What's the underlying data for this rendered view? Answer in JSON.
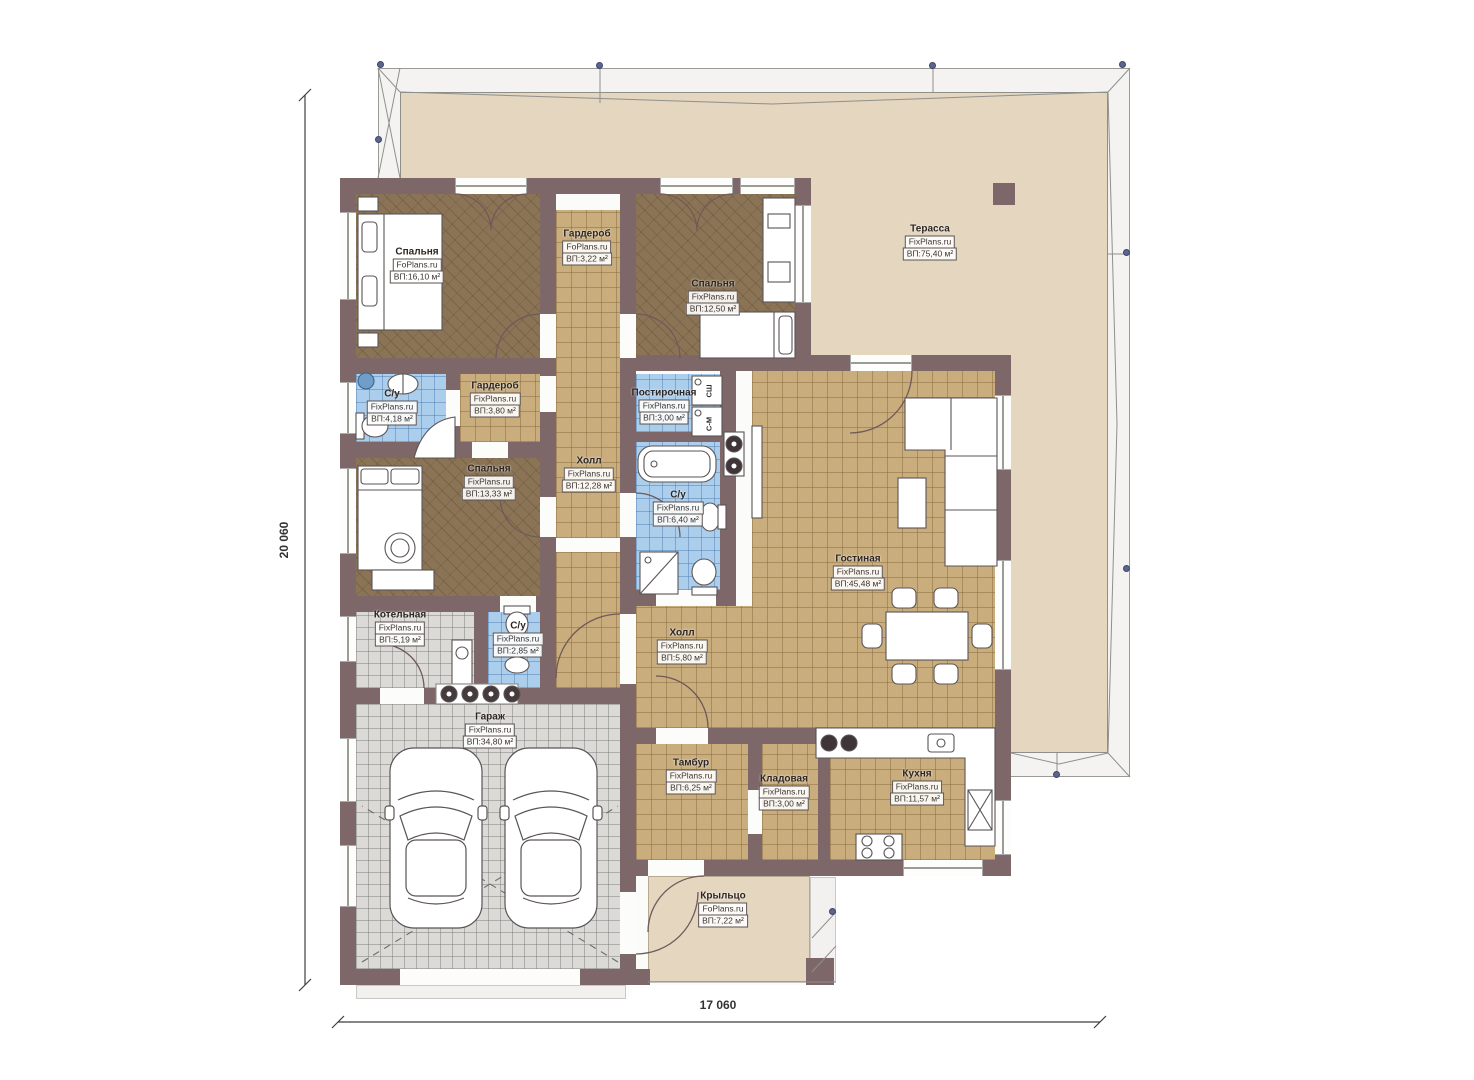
{
  "drawing": {
    "type": "single-storey house floor plan",
    "dimensions": {
      "left": "20 060",
      "bottom": "17 060"
    },
    "area_prefix": "ВП:",
    "colors": {
      "wall": "#7d6769",
      "terrace_floor": "#e4d6bf",
      "wood_floor": "#8b7456",
      "tile_tan": "#c9ad7d",
      "tile_blue": "#abceec",
      "tile_gray": "#dbdad7",
      "survey_dot": "#5b6590"
    },
    "appliances": {
      "dryer": "СШ",
      "washer": "С-М"
    }
  },
  "plan": {
    "rooms": [
      {
        "id": "bedroom-1",
        "name": "Спальня",
        "brand": "FoPlans.ru",
        "area": "ВП:16,10 м²",
        "label": [
          417,
          265
        ],
        "floor": [
          356,
          194,
          184,
          164
        ],
        "floor_type": "wood"
      },
      {
        "id": "wardrobe-top",
        "name": "Гардероб",
        "brand": "FoPlans.ru",
        "area": "ВП:3,22 м²",
        "label": [
          587,
          247
        ],
        "floor": [
          556,
          210,
          64,
          108
        ],
        "floor_type": "tan"
      },
      {
        "id": "bedroom-2",
        "name": "Спальня",
        "brand": "FixPlans.ru",
        "area": "ВП:12,50 м²",
        "label": [
          713,
          297
        ],
        "floor": [
          636,
          194,
          159,
          161
        ],
        "floor_type": "wood"
      },
      {
        "id": "terrace",
        "name": "Терасса",
        "brand": "FixPlans.ru",
        "area": "ВП:75,40 м²",
        "label": [
          930,
          242
        ],
        "floor": null,
        "floor_type": "beige"
      },
      {
        "id": "bath-1",
        "name": "С/у",
        "brand": "FixPlans.ru",
        "area": "ВП:4,18 м²",
        "label": [
          392,
          407
        ],
        "floor": [
          356,
          374,
          90,
          68
        ],
        "floor_type": "blue"
      },
      {
        "id": "wardrobe-2",
        "name": "Гардероб",
        "brand": "FixPlans.ru",
        "area": "ВП:3,80 м²",
        "label": [
          495,
          399
        ],
        "floor": [
          460,
          374,
          80,
          68
        ],
        "floor_type": "tan"
      },
      {
        "id": "bedroom-3",
        "name": "Спальня",
        "brand": "FixPlans.ru",
        "area": "ВП:13,33 м²",
        "label": [
          489,
          482
        ],
        "floor": [
          356,
          458,
          184,
          138
        ],
        "floor_type": "wood"
      },
      {
        "id": "hall-1",
        "name": "Холл",
        "brand": "FixPlans.ru",
        "area": "ВП:12,28 м²",
        "label": [
          589,
          474
        ],
        "floor": [
          556,
          310,
          64,
          378
        ],
        "floor_type": "tan"
      },
      {
        "id": "laundry",
        "name": "Постирочная",
        "brand": "FixPlans.ru",
        "area": "ВП:3,00 м²",
        "label": [
          664,
          406
        ],
        "floor": [
          636,
          374,
          84,
          58
        ],
        "floor_type": "blue"
      },
      {
        "id": "bath-2",
        "name": "С/у",
        "brand": "FixPlans.ru",
        "area": "ВП:6,40 м²",
        "label": [
          678,
          508
        ],
        "floor": [
          636,
          442,
          84,
          148
        ],
        "floor_type": "blue"
      },
      {
        "id": "living-room",
        "name": "Гостиная",
        "brand": "FixPlans.ru",
        "area": "ВП:45,48 м²",
        "label": [
          858,
          572
        ],
        "floor": [
          752,
          371,
          243,
          357
        ],
        "floor_type": "tan"
      },
      {
        "id": "boiler-room",
        "name": "Котельная",
        "brand": "FixPlans.ru",
        "area": "ВП:5,19 м²",
        "label": [
          400,
          628
        ],
        "floor": [
          356,
          612,
          118,
          76
        ],
        "floor_type": "gray"
      },
      {
        "id": "bath-3",
        "name": "С/у",
        "brand": "FixPlans.ru",
        "area": "ВП:2,85 м²",
        "label": [
          518,
          639
        ],
        "floor": [
          488,
          612,
          52,
          76
        ],
        "floor_type": "blue"
      },
      {
        "id": "hall-2",
        "name": "Холл",
        "brand": "FixPlans.ru",
        "area": "ВП:5,80 м²",
        "label": [
          682,
          646
        ],
        "floor": [
          636,
          606,
          116,
          122
        ],
        "floor_type": "tan"
      },
      {
        "id": "garage",
        "name": "Гараж",
        "brand": "FixPlans.ru",
        "area": "ВП:34,80 м²",
        "label": [
          490,
          730
        ],
        "floor": [
          356,
          704,
          264,
          265
        ],
        "floor_type": "gray"
      },
      {
        "id": "vestibule",
        "name": "Тамбур",
        "brand": "FixPlans.ru",
        "area": "ВП:6,25 м²",
        "label": [
          691,
          776
        ],
        "floor": [
          636,
          744,
          112,
          116
        ],
        "floor_type": "tan"
      },
      {
        "id": "storage",
        "name": "Кладовая",
        "brand": "FixPlans.ru",
        "area": "ВП:3,00 м²",
        "label": [
          784,
          792
        ],
        "floor": [
          762,
          744,
          56,
          116
        ],
        "floor_type": "tan"
      },
      {
        "id": "kitchen",
        "name": "Кухня",
        "brand": "FixPlans.ru",
        "area": "ВП:11,57 м²",
        "label": [
          917,
          787
        ],
        "floor": [
          830,
          744,
          165,
          116
        ],
        "floor_type": "tan"
      },
      {
        "id": "porch",
        "name": "Крыльцо",
        "brand": "FoPlans.ru",
        "area": "ВП:7,22 м²",
        "label": [
          723,
          909
        ],
        "floor": [
          648,
          876,
          162,
          106
        ],
        "floor_type": "beige"
      }
    ],
    "roof": {
      "outer": [
        378,
        68,
        752,
        709
      ],
      "inner": [
        400,
        92,
        708,
        661
      ]
    },
    "base": [
      [
        340,
        178,
        471,
        807
      ],
      [
        745,
        355,
        266,
        521
      ]
    ],
    "walls": [
      [
        340,
        178,
        471,
        16
      ],
      [
        340,
        178,
        16,
        807
      ],
      [
        340,
        969,
        310,
        16
      ],
      [
        795,
        178,
        16,
        193
      ],
      [
        811,
        355,
        200,
        16
      ],
      [
        995,
        355,
        16,
        360
      ],
      [
        995,
        715,
        16,
        145
      ],
      [
        810,
        860,
        201,
        16
      ],
      [
        620,
        860,
        200,
        16
      ],
      [
        620,
        194,
        16,
        791
      ],
      [
        540,
        194,
        16,
        402
      ],
      [
        540,
        596,
        16,
        92
      ],
      [
        340,
        358,
        216,
        16
      ],
      [
        340,
        442,
        216,
        16
      ],
      [
        340,
        596,
        216,
        16
      ],
      [
        340,
        688,
        296,
        16
      ],
      [
        446,
        374,
        14,
        68
      ],
      [
        474,
        612,
        14,
        76
      ],
      [
        636,
        355,
        175,
        16
      ],
      [
        636,
        432,
        84,
        10
      ],
      [
        620,
        590,
        116,
        16
      ],
      [
        720,
        358,
        16,
        248
      ],
      [
        620,
        728,
        136,
        16
      ],
      [
        756,
        728,
        60,
        16
      ],
      [
        748,
        744,
        14,
        116
      ],
      [
        818,
        744,
        12,
        116
      ],
      [
        806,
        958,
        28,
        27
      ],
      [
        993,
        183,
        22,
        22
      ]
    ],
    "windows_h": [
      [
        455,
        178,
        72,
        16
      ],
      [
        660,
        178,
        73,
        16
      ],
      [
        740,
        178,
        55,
        16
      ],
      [
        850,
        355,
        62,
        16
      ],
      [
        903,
        860,
        80,
        16
      ]
    ],
    "windows_v": [
      [
        340,
        212,
        16,
        88
      ],
      [
        340,
        382,
        16,
        52
      ],
      [
        340,
        468,
        16,
        86
      ],
      [
        340,
        616,
        16,
        46
      ],
      [
        340,
        738,
        16,
        64
      ],
      [
        340,
        845,
        16,
        62
      ],
      [
        795,
        205,
        16,
        98
      ],
      [
        995,
        395,
        16,
        75
      ],
      [
        995,
        560,
        16,
        110
      ],
      [
        995,
        800,
        16,
        55
      ]
    ],
    "doors": [
      [
        540,
        314,
        16,
        44
      ],
      [
        540,
        376,
        16,
        36
      ],
      [
        540,
        497,
        16,
        40
      ],
      [
        620,
        314,
        16,
        44
      ],
      [
        620,
        493,
        16,
        44
      ],
      [
        620,
        614,
        16,
        70
      ],
      [
        620,
        892,
        16,
        62
      ],
      [
        446,
        390,
        14,
        36
      ],
      [
        472,
        442,
        36,
        16
      ],
      [
        500,
        596,
        36,
        16
      ],
      [
        380,
        688,
        44,
        16
      ],
      [
        656,
        728,
        52,
        16
      ],
      [
        648,
        860,
        56,
        16
      ],
      [
        656,
        590,
        60,
        16
      ],
      [
        556,
        538,
        64,
        14
      ],
      [
        748,
        790,
        14,
        44
      ],
      [
        400,
        969,
        180,
        16
      ]
    ],
    "light_rects": [
      [
        356,
        985,
        270,
        14
      ],
      [
        810,
        877,
        26,
        105
      ]
    ],
    "dots": [
      [
        381,
        65
      ],
      [
        600,
        66
      ],
      [
        933,
        66
      ],
      [
        1123,
        65
      ],
      [
        379,
        140
      ],
      [
        1127,
        253
      ],
      [
        1127,
        569
      ],
      [
        1057,
        775
      ],
      [
        833,
        912
      ]
    ]
  }
}
